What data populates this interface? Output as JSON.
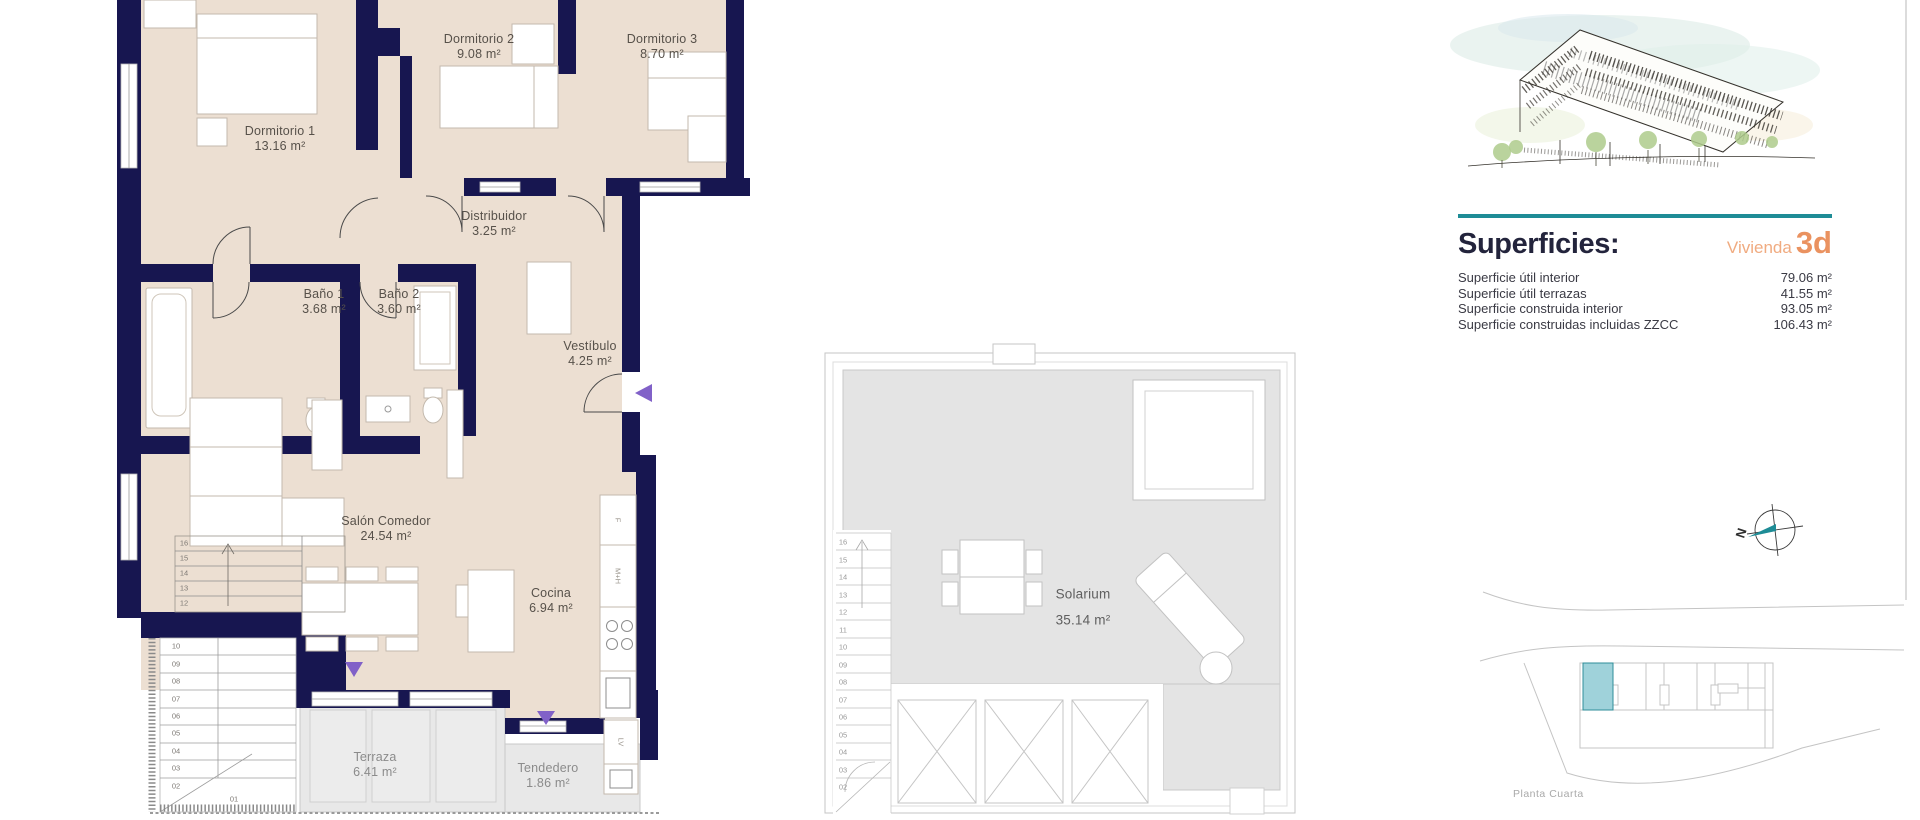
{
  "plan_main": {
    "rooms": [
      {
        "name": "Dormitorio 1",
        "area": "13.16 m²"
      },
      {
        "name": "Dormitorio 2",
        "area": "9.08 m²"
      },
      {
        "name": "Dormitorio 3",
        "area": "8.70 m²"
      },
      {
        "name": "Distribuidor",
        "area": "3.25 m²"
      },
      {
        "name": "Baño 1",
        "area": "3.68 m²"
      },
      {
        "name": "Baño 2",
        "area": "3.60 m²"
      },
      {
        "name": "Vestíbulo",
        "area": "4.25 m²"
      },
      {
        "name": "Salón Comedor",
        "area": "24.54 m²"
      },
      {
        "name": "Cocina",
        "area": "6.94 m²"
      },
      {
        "name": "Terraza",
        "area": "6.41 m²"
      },
      {
        "name": "Tendedero",
        "area": "1.86 m²"
      }
    ],
    "stair_upper_numbers": [
      "16",
      "15",
      "14",
      "13",
      "12"
    ],
    "stair_lower_numbers": [
      "10",
      "09",
      "08",
      "07",
      "06",
      "05",
      "04",
      "03",
      "02"
    ],
    "stair_first_step": "01",
    "appliance_labels": {
      "fridge": "F",
      "oven_micro": "M+H",
      "washer": "LV"
    }
  },
  "plan_solarium": {
    "room_name": "Solarium",
    "room_area": "35.14 m²",
    "stair_numbers": [
      "16",
      "15",
      "14",
      "13",
      "12",
      "11",
      "10",
      "09",
      "08",
      "07",
      "06",
      "05",
      "04",
      "03",
      "02"
    ]
  },
  "panel": {
    "title": "Superficies:",
    "unit_label": "Vivienda",
    "unit_code": "3d",
    "rows": [
      {
        "label": "Superficie útil interior",
        "value": "79.06 m²"
      },
      {
        "label": "Superficie útil terrazas",
        "value": "41.55 m²"
      },
      {
        "label": "Superficie construida interior",
        "value": "93.05 m²"
      },
      {
        "label": "Superficie construidas incluidas ZZCC",
        "value": "106.43 m²"
      }
    ]
  },
  "site_plan": {
    "caption": "Planta Cuarta",
    "north_label": "N"
  },
  "colors": {
    "wall": "#171650",
    "room_fill": "#ecdfd2",
    "teal_accent": "#1e8c96",
    "orange_accent": "#ea9260",
    "terrace_fill": "#e8e8e8",
    "marker_purple": "#8161c8",
    "site_highlight_fill": "#9fd2da",
    "title_navy": "#23243c"
  }
}
